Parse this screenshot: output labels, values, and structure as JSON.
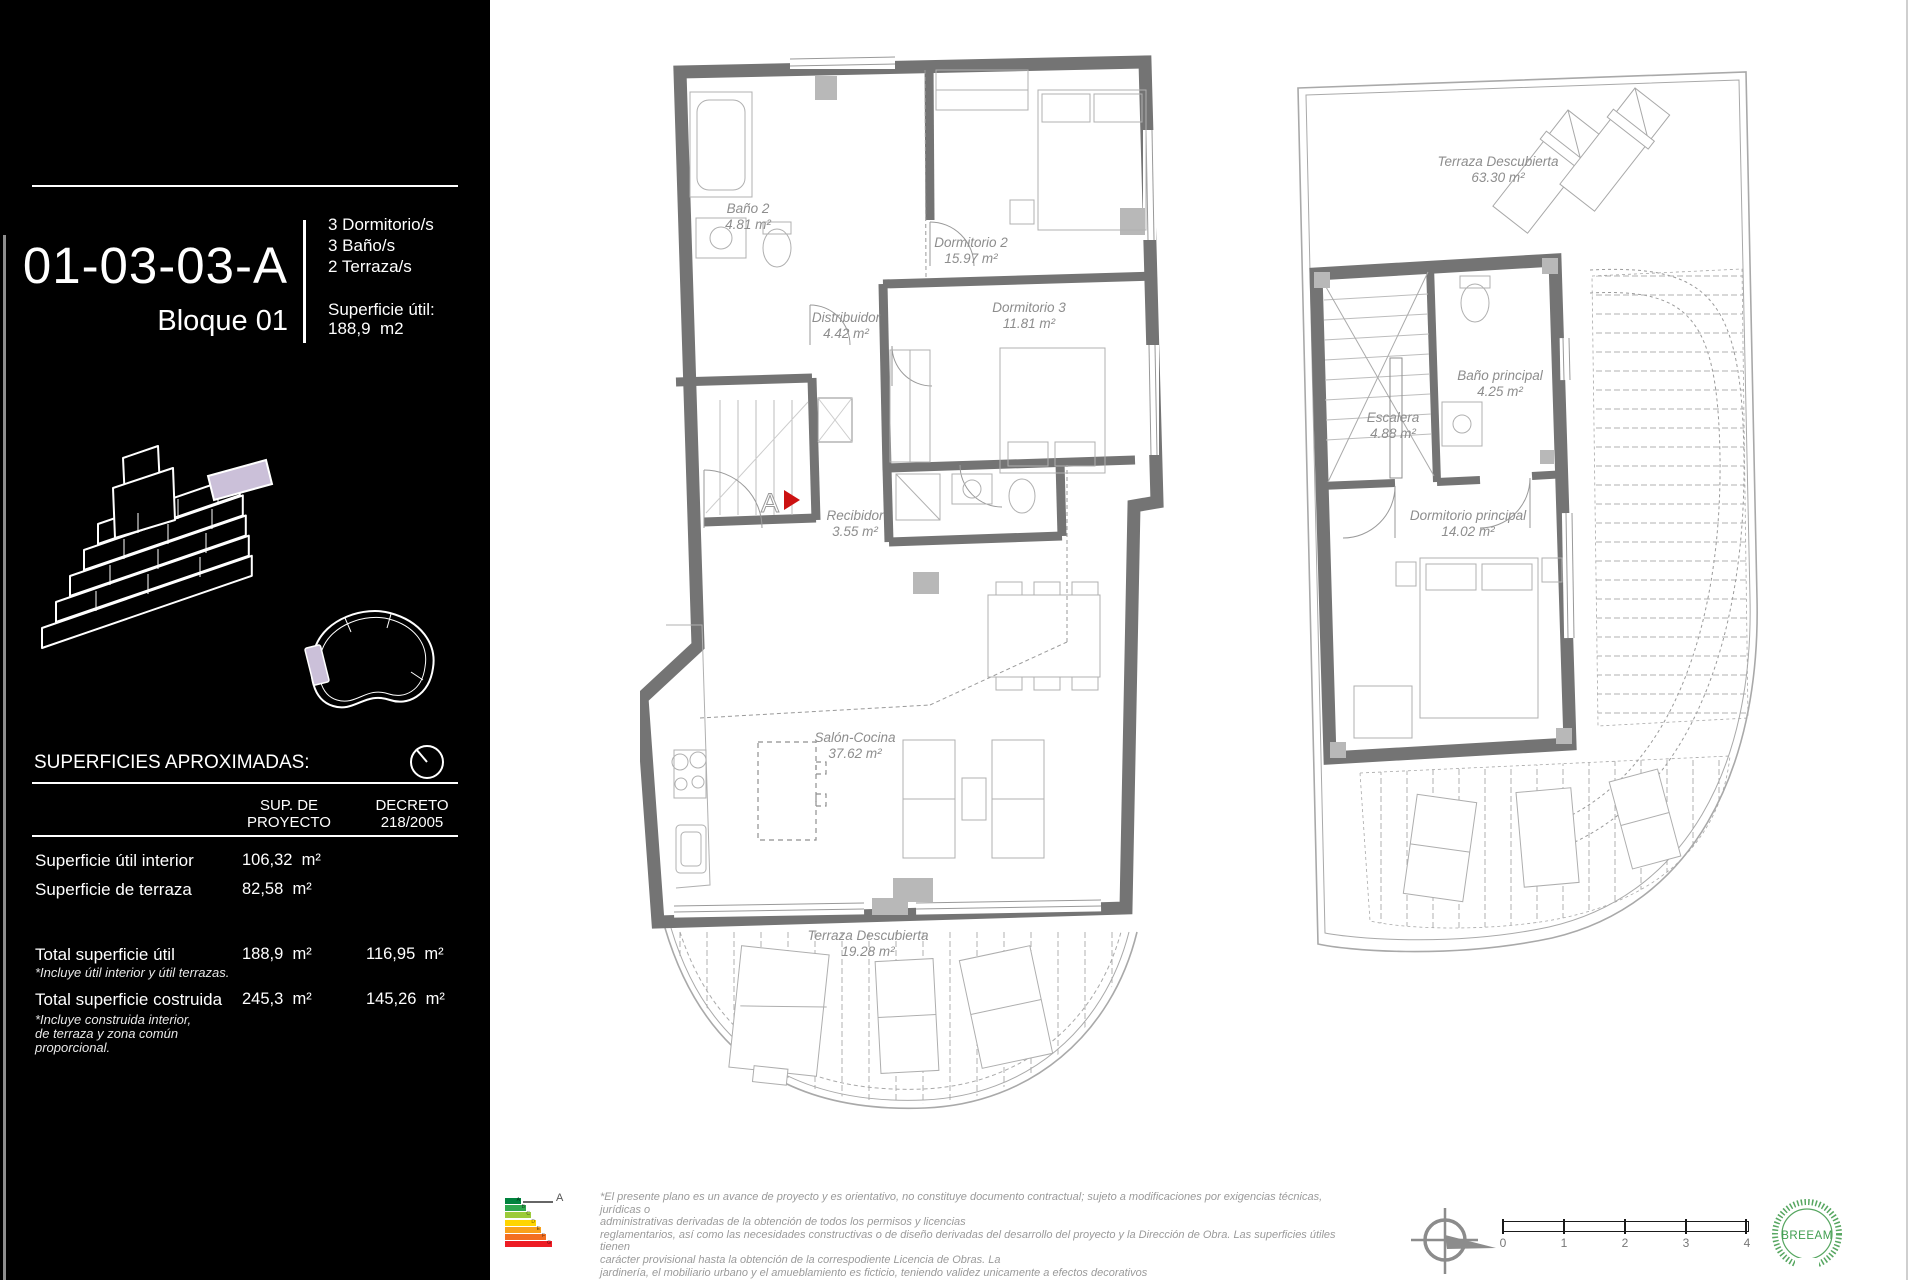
{
  "sidebar": {
    "unit_code": "01-03-03-A",
    "block": "Bloque 01",
    "features": [
      "3 Dormitorio/s",
      "3 Baño/s",
      "2 Terraza/s"
    ],
    "superficie": {
      "label": "Superficie útil:",
      "value": "188,9  m2"
    },
    "approx_title": "SUPERFICIES APROXIMADAS:",
    "table": {
      "col1_header": "SUP. DE\nPROYECTO",
      "col2_header": "DECRETO\n218/2005",
      "rows": [
        {
          "label": "Superficie útil interior",
          "proyecto": "106,32  m²",
          "decreto": "",
          "note": ""
        },
        {
          "label": "Superficie de terraza",
          "proyecto": "82,58  m²",
          "decreto": "",
          "note": ""
        },
        {
          "label": "Total superficie útil",
          "proyecto": "188,9  m²",
          "decreto": "116,95  m²",
          "note": "*Incluye útil interior y útil terrazas."
        },
        {
          "label": "Total superficie costruida",
          "proyecto": "245,3  m²",
          "decreto": "145,26  m²",
          "note": "*Incluye construida interior,\nde terraza y zona común\nproporcional."
        }
      ]
    },
    "highlight_color": "#cbc0d9"
  },
  "plan_a": {
    "rooms": {
      "bano2": {
        "name": "Baño 2",
        "area": "4.81 m²"
      },
      "dormitorio2": {
        "name": "Dormitorio 2",
        "area": "15.97 m²"
      },
      "dormitorio3": {
        "name": "Dormitorio 3",
        "area": "11.81 m²"
      },
      "distribuidor": {
        "name": "Distribuidor",
        "area": "4.42 m²"
      },
      "recibidor": {
        "name": "Recibidor",
        "area": "3.55 m²"
      },
      "salon": {
        "name": "Salón-Cocina",
        "area": "37.62 m²"
      },
      "terraza": {
        "name": "Terraza Descubierta",
        "area": "19.28 m²"
      }
    },
    "entrance_label": "A",
    "entrance_marker_color": "#cc1111"
  },
  "plan_b": {
    "rooms": {
      "terraza": {
        "name": "Terraza Descubierta",
        "area": "63.30 m²"
      },
      "escalera": {
        "name": "Escalera",
        "area": "4.88 m²"
      },
      "bano_principal": {
        "name": "Baño principal",
        "area": "4.25 m²"
      },
      "dormitorio_principal": {
        "name": "Dormitorio principal",
        "area": "14.02 m²"
      }
    }
  },
  "footer": {
    "energy": {
      "grades": [
        "A",
        "B",
        "C",
        "D",
        "E",
        "F",
        "G"
      ],
      "current": "A",
      "colors": [
        "#00833e",
        "#2ea84e",
        "#9ccb3b",
        "#ffd500",
        "#f9a11b",
        "#f36f21",
        "#ed1c24"
      ]
    },
    "disclaimer": {
      "l1": "*El presente plano es un avance de proyecto y es orientativo, no constituye documento contractual; sujeto a modificaciones por exigencias técnicas, jurídicas o",
      "l2": "administrativas derivadas de la obtención de todos los permisos y licencias",
      "l3": "reglamentarios, así como las necesidades constructivas o de diseño derivadas del desarrollo del proyecto y la Dirección de Obra. Las superficies útiles tienen",
      "l4": "carácter provisional hasta la obtención de la correspodiente Licencia de Obras. La",
      "l5": "jardinería, el mobiliario urbano y el amueblamiento es ficticio, teniendo validez unicamente a efectos decorativos"
    },
    "scale_ticks": [
      "0",
      "1",
      "2",
      "3",
      "4"
    ],
    "breeam_label": "BREEAM"
  }
}
